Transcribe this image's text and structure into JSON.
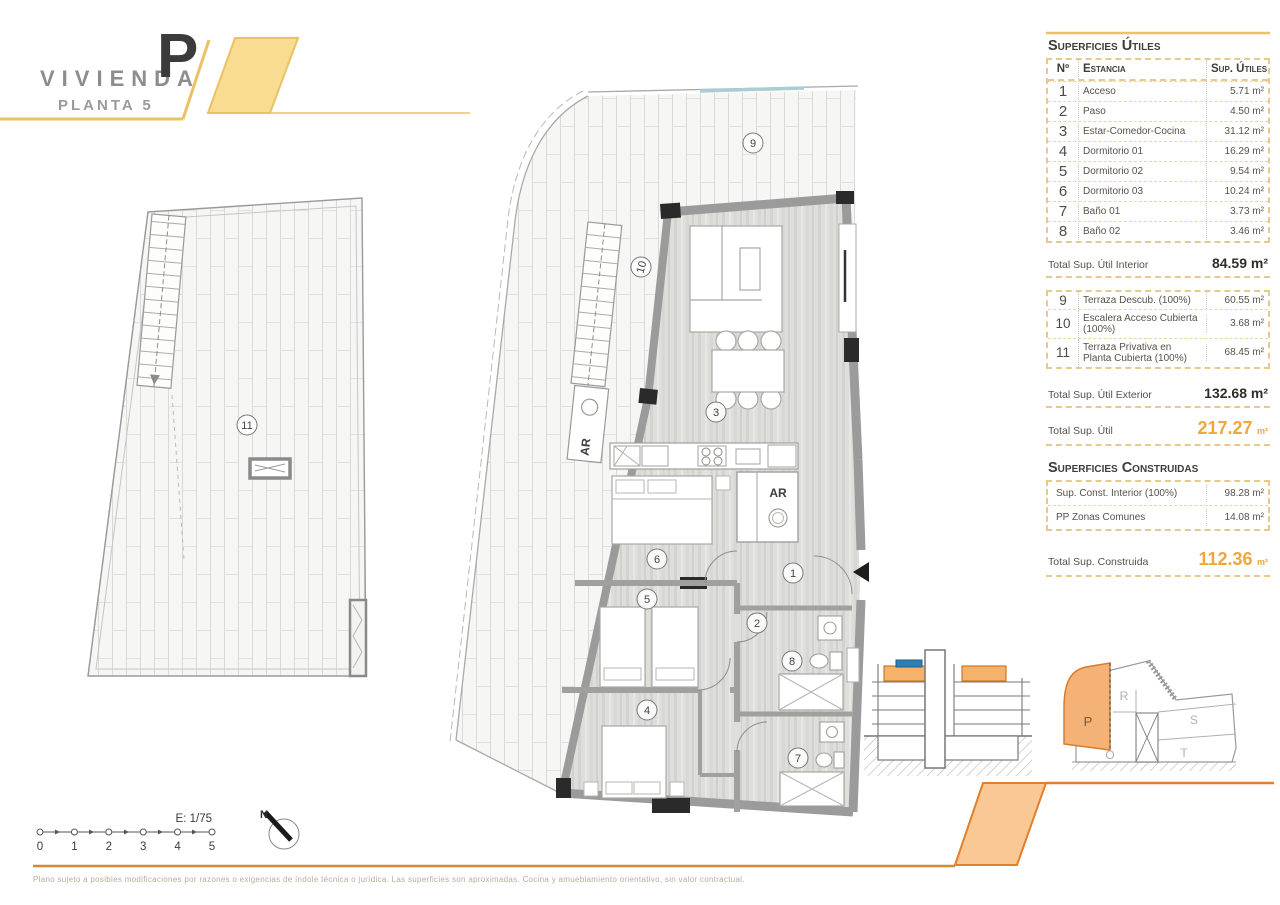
{
  "header": {
    "title": "VIVIENDA",
    "unit_letter": "P",
    "subtitle": "PLANTA 5"
  },
  "tables": {
    "utiles": {
      "title": "Superficies Útiles",
      "columns": {
        "num": "Nº",
        "room": "Estancia",
        "area": "Sup. Útiles"
      },
      "rows": [
        {
          "num": "1",
          "room": "Acceso",
          "area": "5.71 m²"
        },
        {
          "num": "2",
          "room": "Paso",
          "area": "4.50 m²"
        },
        {
          "num": "3",
          "room": "Estar-Comedor-Cocina",
          "area": "31.12 m²"
        },
        {
          "num": "4",
          "room": "Dormitorio 01",
          "area": "16.29 m²"
        },
        {
          "num": "5",
          "room": "Dormitorio 02",
          "area": "9.54 m²"
        },
        {
          "num": "6",
          "room": "Dormitorio 03",
          "area": "10.24 m²"
        },
        {
          "num": "7",
          "room": "Baño 01",
          "area": "3.73 m²"
        },
        {
          "num": "8",
          "room": "Baño 02",
          "area": "3.46 m²"
        }
      ],
      "total_interior": {
        "label": "Total Sup. Útil Interior",
        "value": "84.59 m²"
      },
      "exterior_rows": [
        {
          "num": "9",
          "room": "Terraza Descub. (100%)",
          "area": "60.55 m²"
        },
        {
          "num": "10",
          "room": "Escalera Acceso Cubierta (100%)",
          "area": "3.68 m²"
        },
        {
          "num": "11",
          "room": "Terraza Privativa en Planta Cubierta (100%)",
          "area": "68.45 m²"
        }
      ],
      "total_exterior": {
        "label": "Total Sup. Útil Exterior",
        "value": "132.68 m²"
      },
      "total": {
        "label": "Total Sup. Útil",
        "value": "217.27",
        "unit": "m²"
      }
    },
    "construidas": {
      "title": "Superficies Construidas",
      "rows": [
        {
          "room": "Sup. Const. Interior (100%)",
          "area": "98.28 m²"
        },
        {
          "room": "PP Zonas Comunes",
          "area": "14.08 m²"
        }
      ],
      "total": {
        "label": "Total Sup. Construida",
        "value": "112.36",
        "unit": "m²"
      }
    }
  },
  "plan": {
    "labels": {
      "1": "1",
      "2": "2",
      "3": "3",
      "4": "4",
      "5": "5",
      "6": "6",
      "7": "7",
      "8": "8",
      "9": "9",
      "10": "10",
      "11": "11"
    },
    "ar_closet": "AR",
    "ar_stairs": "AR"
  },
  "scale_bar": {
    "label": "E: 1/75",
    "ticks": [
      "0",
      "1",
      "2",
      "3",
      "4",
      "5"
    ],
    "north": "N"
  },
  "site_key": {
    "units": {
      "p": "P",
      "r": "R",
      "s": "S",
      "t": "T",
      "o": "O"
    }
  },
  "footer": {
    "disclaimer": "Plano sujeto a posibles modificaciones por razones o exigencias de índole técnica o jurídica. Las superficies son aproximadas. Cocina y amueblamiento orientativo, sin valor contractual."
  },
  "colors": {
    "accent_yellow": "#eac263",
    "accent_yellow_fill": "#f7dc92",
    "accent_orange": "#e1802c",
    "accent_orange_fill": "#f9c895",
    "value_orange": "#efa63e",
    "wall_gray": "#9b9b9b",
    "section_highlight": "#f5b26a",
    "section_blue": "#2e7fb0",
    "glass_teal": "#a8cdd3"
  }
}
